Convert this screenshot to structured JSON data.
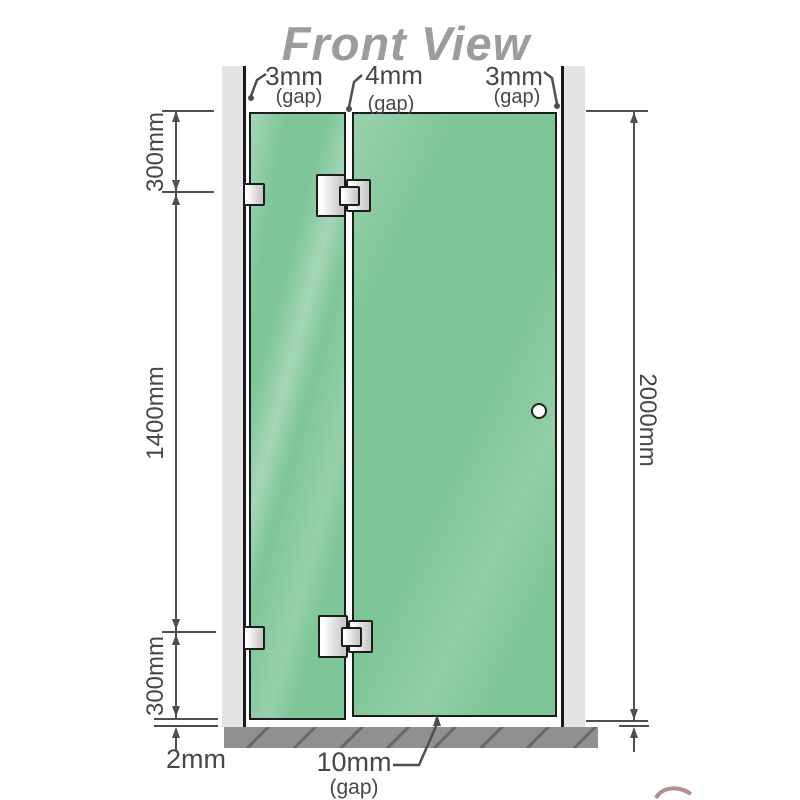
{
  "title": "Front View",
  "view": {
    "description": "shower screen front elevation diagram"
  },
  "dimensions": {
    "top_left": {
      "value": "3mm",
      "qualifier": "(gap)"
    },
    "top_middle": {
      "value": "4mm",
      "qualifier": "(gap)"
    },
    "top_right": {
      "value": "3mm",
      "qualifier": "(gap)"
    },
    "left_upper": "300mm",
    "left_middle": "1400mm",
    "left_lower": "300mm",
    "right_overall": "2000mm",
    "bottom_left": "2mm",
    "bottom_middle": {
      "value": "10mm",
      "qualifier": "(gap)"
    }
  },
  "colors": {
    "glass_green": "#7ec597",
    "wall_gray": "#e4e4e4",
    "base_gray": "#8e9092",
    "line": "#4f4f4f",
    "outline": "#1c1c1c",
    "title_gray": "#9c9c9c",
    "hardware_light": "#ffffff",
    "hardware_shade": "#c9c9c9"
  }
}
